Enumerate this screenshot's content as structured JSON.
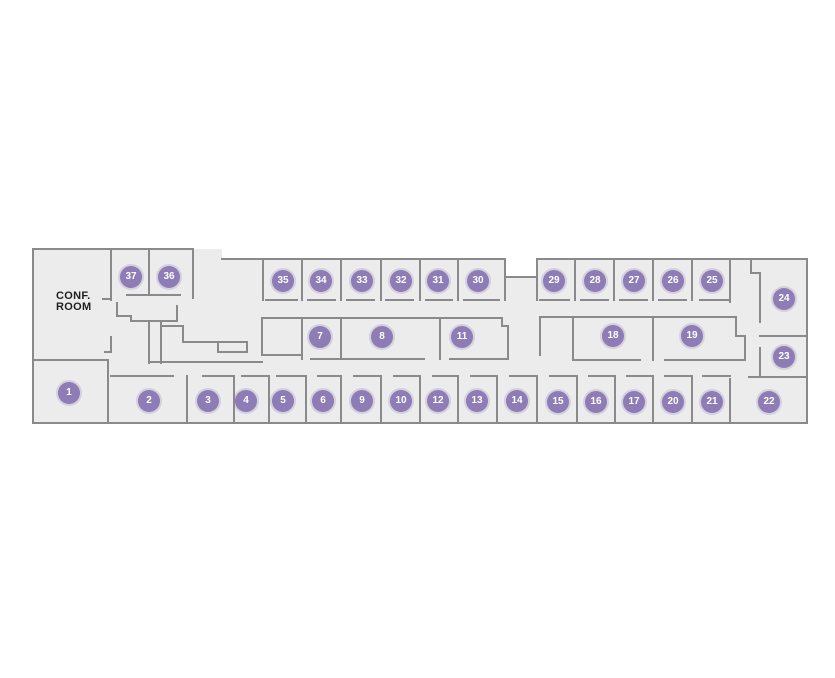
{
  "floor_plan": {
    "conf_room_label": "CONF. ROOM",
    "colors": {
      "background": "#ffffff",
      "floor_fill": "#ececec",
      "wall": "#8a8a8a",
      "badge_fill": "#8d7cb5",
      "badge_text": "#ffffff",
      "label_text": "#1f1f1f"
    },
    "rooms": [
      {
        "number": "1"
      },
      {
        "number": "2"
      },
      {
        "number": "3"
      },
      {
        "number": "4"
      },
      {
        "number": "5"
      },
      {
        "number": "6"
      },
      {
        "number": "7"
      },
      {
        "number": "8"
      },
      {
        "number": "9"
      },
      {
        "number": "10"
      },
      {
        "number": "11"
      },
      {
        "number": "12"
      },
      {
        "number": "13"
      },
      {
        "number": "14"
      },
      {
        "number": "15"
      },
      {
        "number": "16"
      },
      {
        "number": "17"
      },
      {
        "number": "18"
      },
      {
        "number": "19"
      },
      {
        "number": "20"
      },
      {
        "number": "21"
      },
      {
        "number": "22"
      },
      {
        "number": "23"
      },
      {
        "number": "24"
      },
      {
        "number": "25"
      },
      {
        "number": "26"
      },
      {
        "number": "27"
      },
      {
        "number": "28"
      },
      {
        "number": "29"
      },
      {
        "number": "30"
      },
      {
        "number": "31"
      },
      {
        "number": "32"
      },
      {
        "number": "33"
      },
      {
        "number": "34"
      },
      {
        "number": "35"
      },
      {
        "number": "36"
      },
      {
        "number": "37"
      }
    ]
  }
}
